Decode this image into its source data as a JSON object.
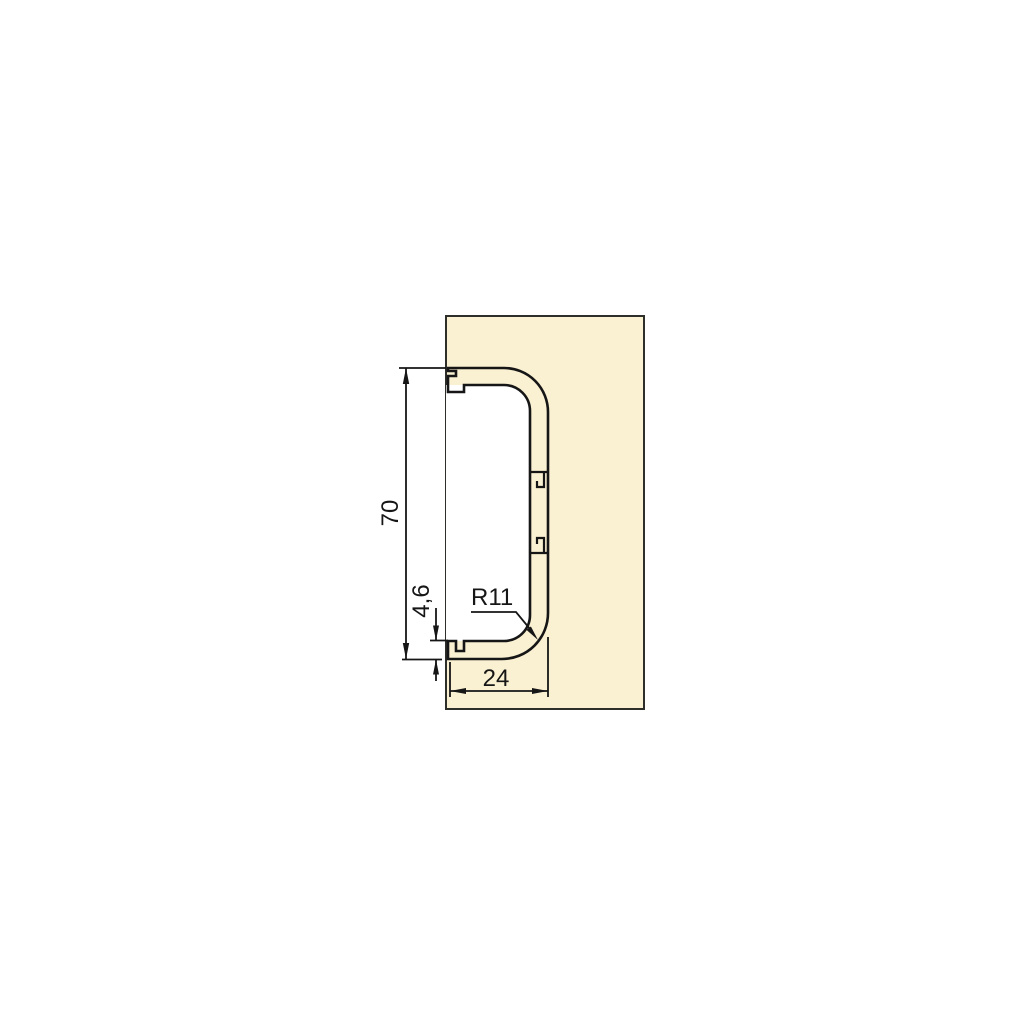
{
  "drawing": {
    "type": "profile-cross-section",
    "dimensions": {
      "height_label": "70",
      "flange_thickness_label": "4,6",
      "radius_label": "R11",
      "depth_label": "24"
    }
  },
  "colors": {
    "background": "#ffffff",
    "panel_fill": "#FAF0D2",
    "panel_stroke": "#2E2E2B",
    "profile_fill": "#EBEBE8",
    "line_color": "#161616"
  }
}
